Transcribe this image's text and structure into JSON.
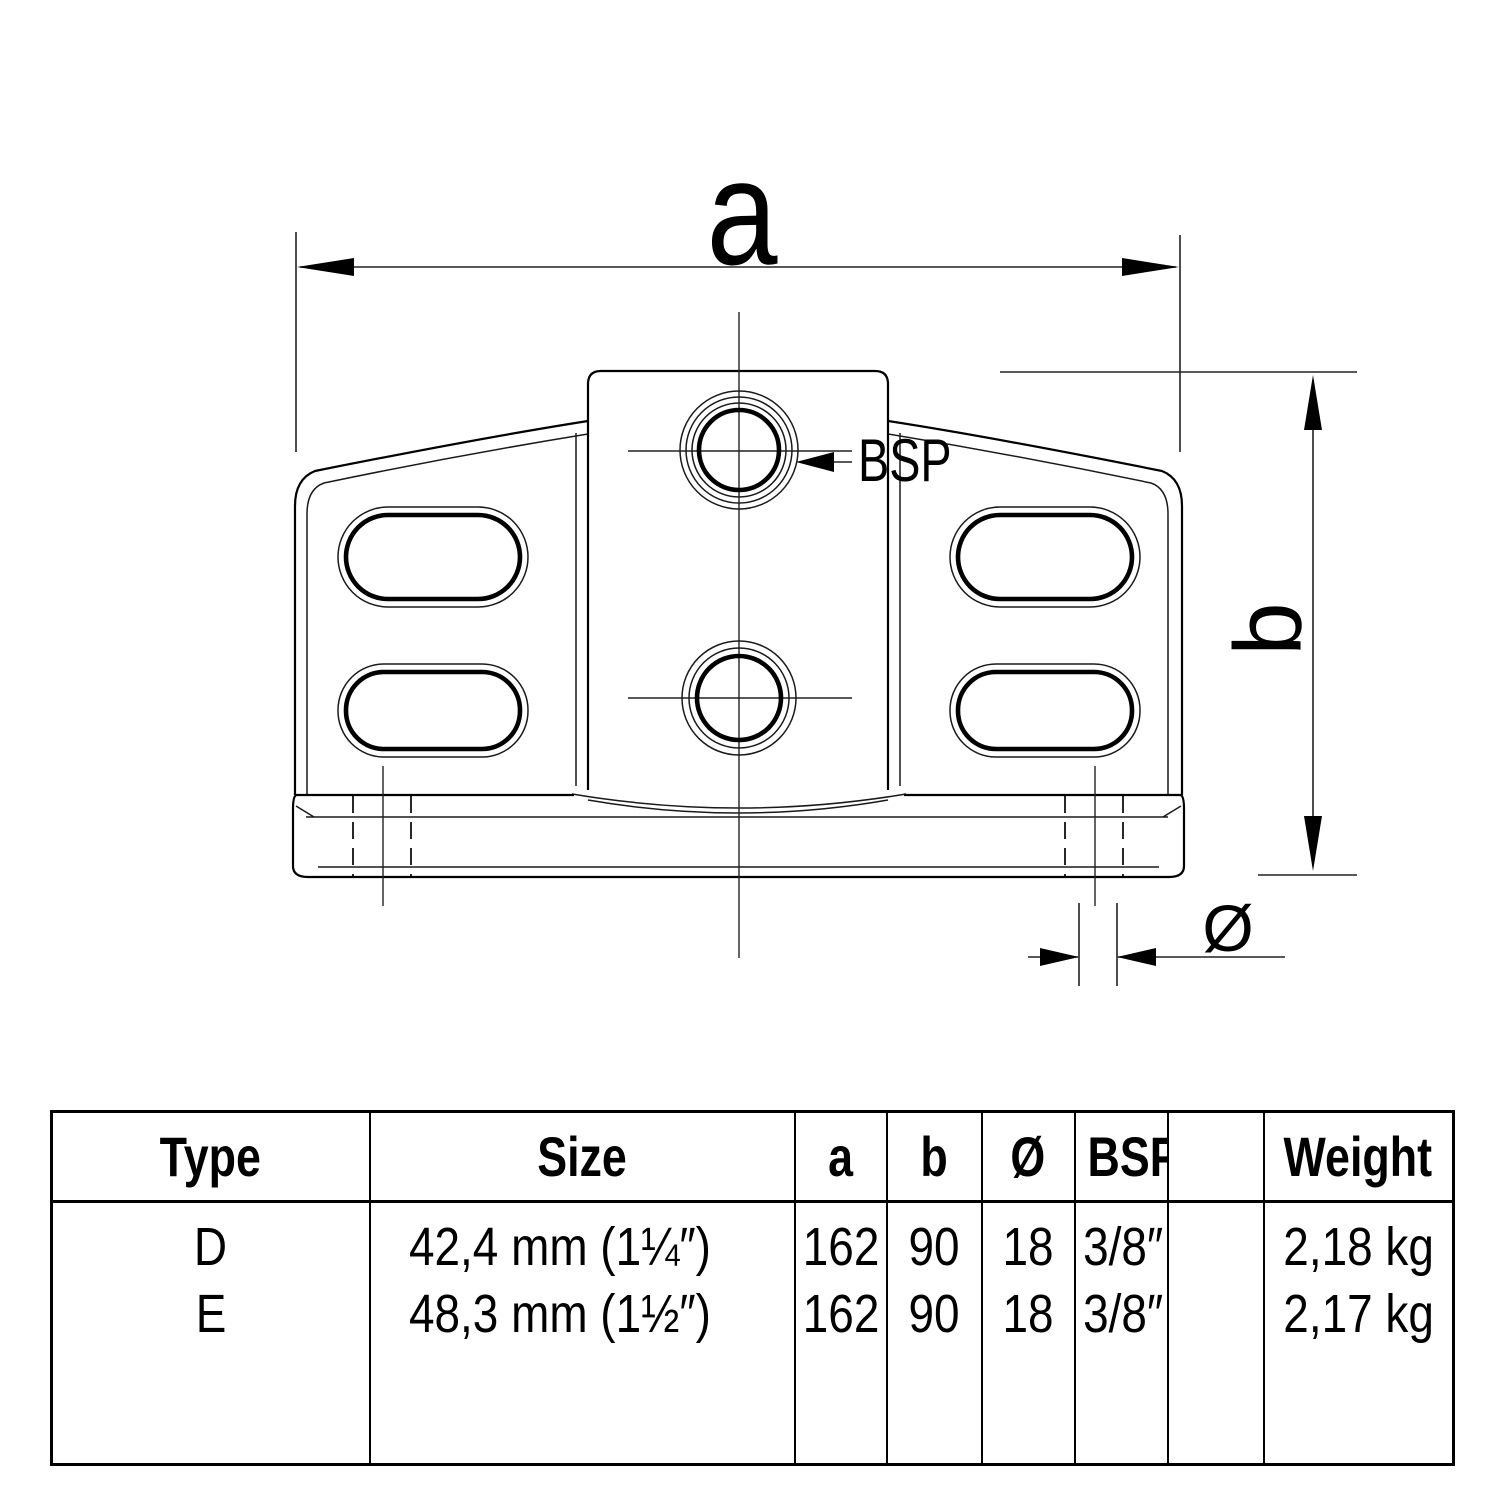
{
  "drawing": {
    "labels": {
      "dim_a": "a",
      "dim_b": "b",
      "bsp": "BSP",
      "diameter": "Ø"
    },
    "line_color": "#000000",
    "background": "#ffffff"
  },
  "table": {
    "headers": [
      "Type",
      "Size",
      "a",
      "b",
      "Ø",
      "BSP",
      "",
      "Weight"
    ],
    "rows": [
      [
        "D",
        "42,4 mm (1¼″)",
        "162",
        "90",
        "18",
        "3/8″",
        "",
        "2,18 kg"
      ],
      [
        "E",
        "48,3 mm (1½″)",
        "162",
        "90",
        "18",
        "3/8″",
        "",
        "2,17 kg"
      ]
    ]
  }
}
